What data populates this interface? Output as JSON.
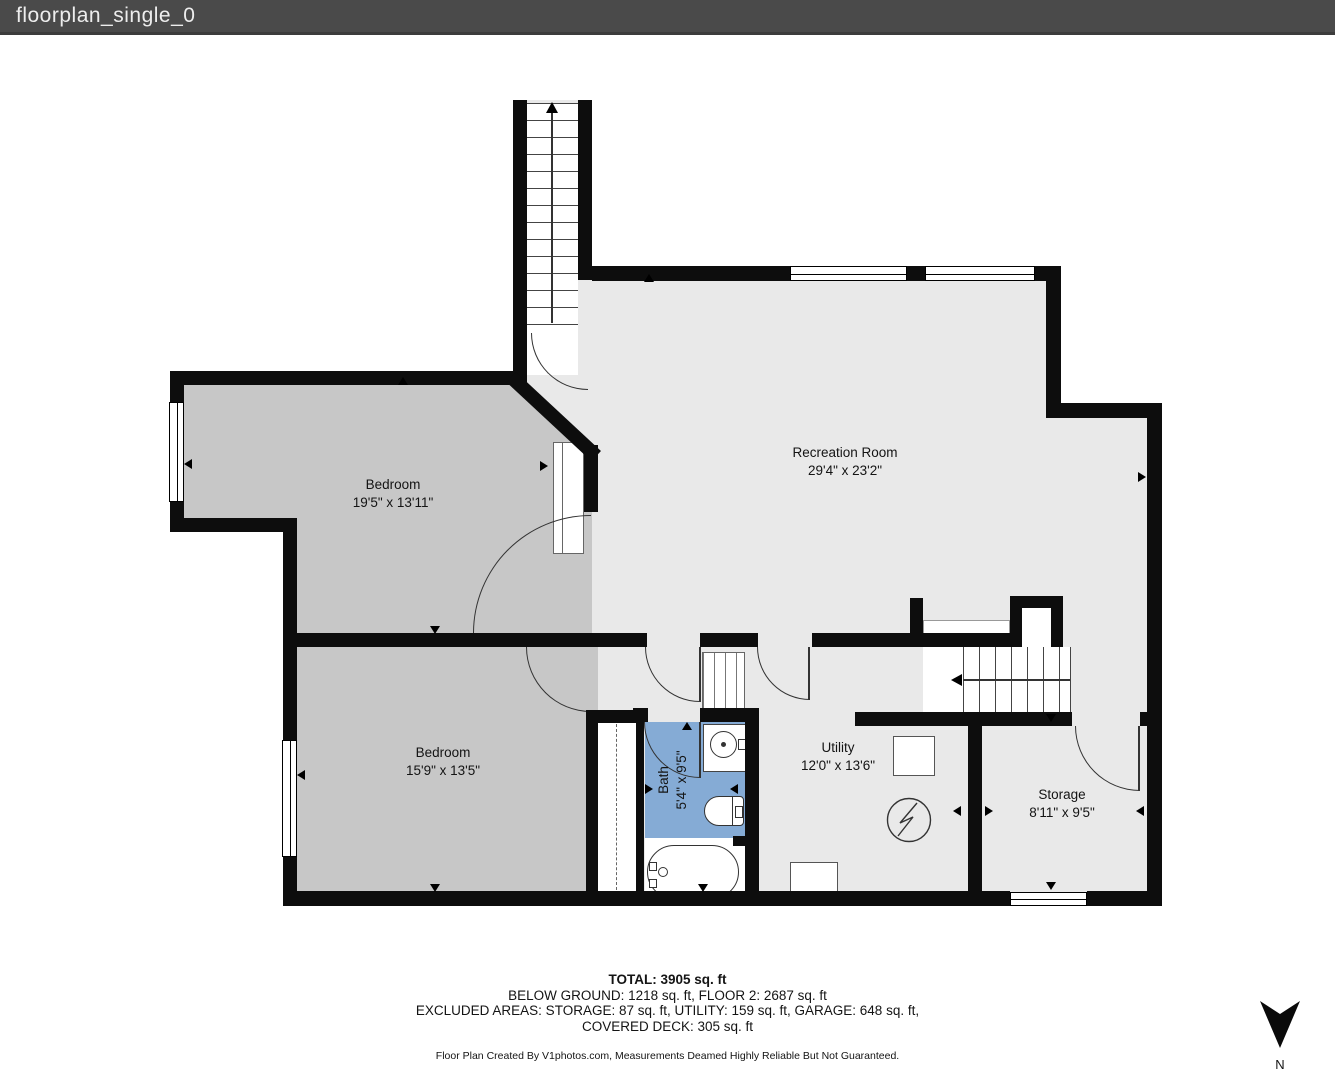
{
  "header": {
    "title": "floorplan_single_0"
  },
  "colors": {
    "header_bg": "#4a4a4a",
    "wall": "#0d0d0d",
    "room_gray": "#c7c7c7",
    "floor_light": "#e9e9e9",
    "bath_blue": "#85abd5",
    "text": "#141414"
  },
  "rooms": [
    {
      "id": "bedroom-1",
      "name": "Bedroom",
      "dims": "19'5\" x 13'11\""
    },
    {
      "id": "bedroom-2",
      "name": "Bedroom",
      "dims": "15'9\" x 13'5\""
    },
    {
      "id": "recreation-room",
      "name": "Recreation Room",
      "dims": "29'4\" x 23'2\""
    },
    {
      "id": "bath",
      "name": "Bath",
      "dims": "5'4\" x 9'5\""
    },
    {
      "id": "utility",
      "name": "Utility",
      "dims": "12'0\" x 13'6\""
    },
    {
      "id": "storage",
      "name": "Storage",
      "dims": "8'11\" x 9'5\""
    }
  ],
  "footer": {
    "total": "TOTAL: 3905 sq. ft",
    "line2": "BELOW GROUND: 1218 sq. ft, FLOOR 2: 2687 sq. ft",
    "line3": "EXCLUDED AREAS: STORAGE: 87 sq. ft, UTILITY: 159 sq. ft, GARAGE: 648 sq. ft,",
    "line4": "COVERED DECK: 305 sq. ft",
    "disclaimer": "Floor Plan Created By V1photos.com, Measurements Deamed Highly Reliable But Not Guaranteed."
  },
  "compass": {
    "label": "N"
  }
}
